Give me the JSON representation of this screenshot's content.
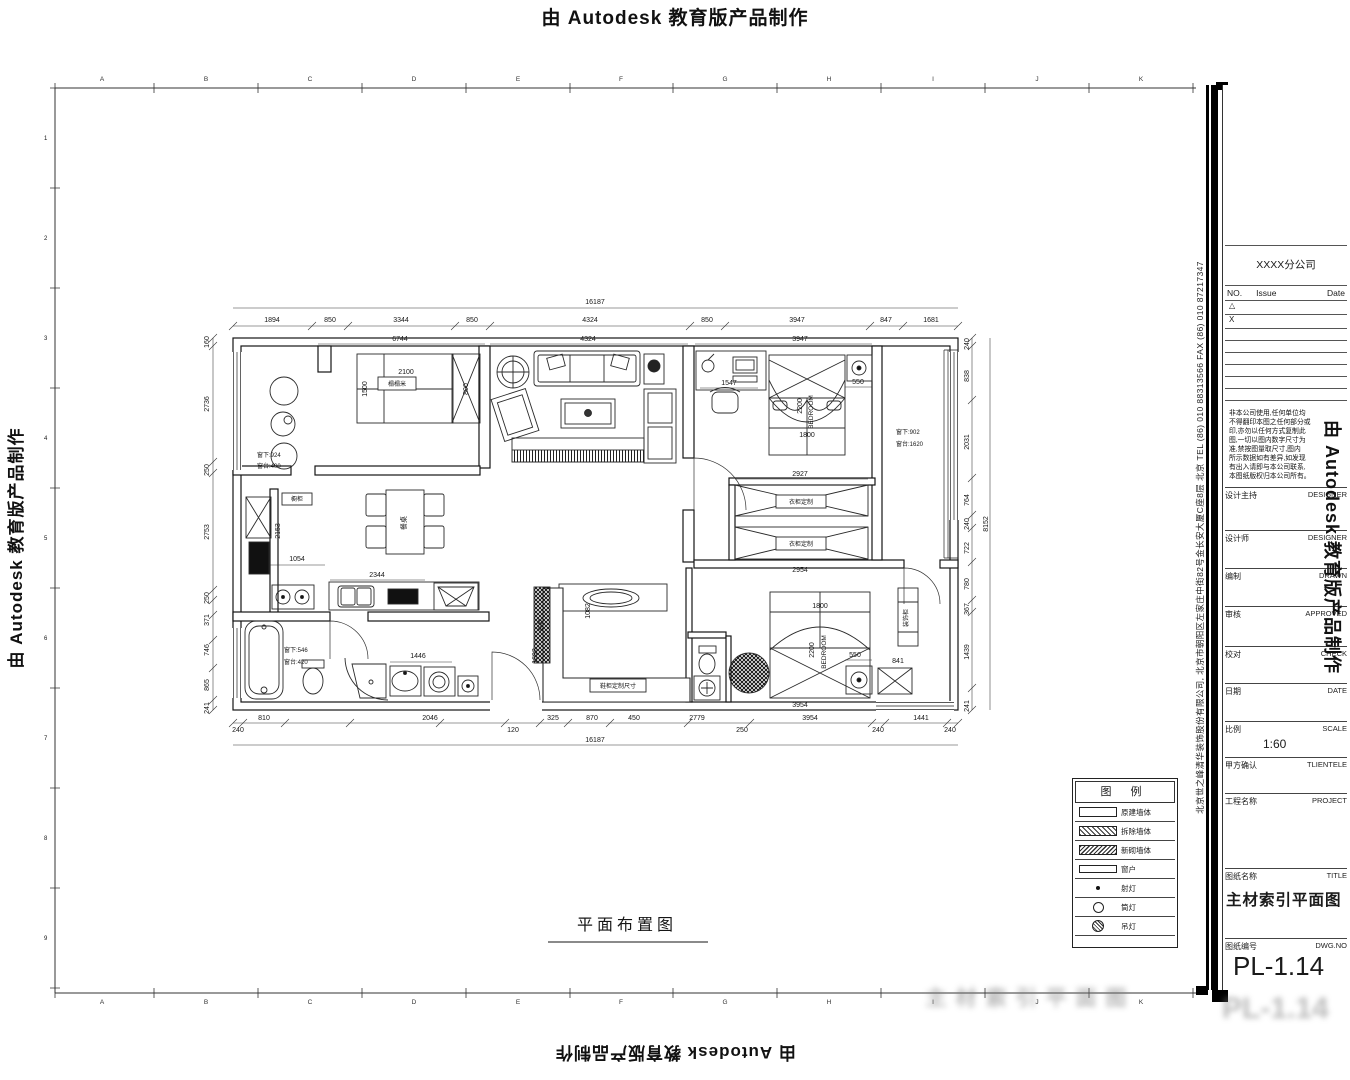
{
  "banner": {
    "text": "由 Autodesk 教育版产品制作"
  },
  "ruler": {
    "letters": [
      "A",
      "B",
      "C",
      "D",
      "E",
      "F",
      "G",
      "H",
      "I",
      "J",
      "K"
    ],
    "numbers": [
      "1",
      "2",
      "3",
      "4",
      "5",
      "6",
      "7",
      "8",
      "9"
    ]
  },
  "plan": {
    "title": "平面布置图",
    "overall_top": "16187",
    "overall_bottom": "16187",
    "overall_right": "8152",
    "d_top": [
      "1894",
      "850",
      "3344",
      "850",
      "4324",
      "850",
      "3947",
      "847",
      "1681"
    ],
    "d_top_inner": [
      "6744",
      "4324",
      "3947"
    ],
    "d_bottom": [
      "240",
      "810",
      "2046",
      "120",
      "325",
      "870",
      "450",
      "2779",
      "250",
      "3954",
      "240",
      "1441",
      "240"
    ],
    "d_left": [
      "160",
      "2736",
      "250",
      "2753",
      "250",
      "371",
      "746",
      "865",
      "241"
    ],
    "d_right": [
      "240",
      "838",
      "2031",
      "764",
      "240",
      "722",
      "780",
      "367",
      "1439",
      "241"
    ],
    "dims": {
      "tatami_w": "2100",
      "tatami_d": "1500",
      "closet_w": "800",
      "desk": "1547",
      "nightstand": "550",
      "ward1": "2927",
      "ward2": "2954",
      "bed1_w": "1800",
      "bed1_d": "2200",
      "bed2_w": "1800",
      "bed2_d": "2200",
      "bed2_wall": "3954",
      "kitchen_d": "2153",
      "kitchen_w": "1054",
      "counter": "2344",
      "bath": "1446",
      "foyer": "1692",
      "shoe": "1082",
      "night2": "550",
      "side": "841"
    },
    "labels": {
      "bedroom": "BEDROOM",
      "tatami": "榻榻米",
      "dining": "餐桌",
      "wardrobe": "衣柜定制",
      "shoe_cab": "鞋柜",
      "shoe_note": "鞋柜定制尺寸",
      "display": "装饰柜",
      "kitchen": "橱柜"
    },
    "notes": {
      "win_l1": "窗下:924",
      "win_l2": "窗台:400",
      "win_r1": "窗下:902",
      "win_r2": "窗台:1620",
      "win_b1": "窗下:546",
      "win_b2": "窗台:420"
    }
  },
  "legend": {
    "title": "图 例",
    "rows": [
      "原建墙体",
      "拆除墙体",
      "新砌墙体",
      "窗户",
      "射灯",
      "筒灯",
      "吊灯"
    ]
  },
  "titleblock": {
    "branch": "XXXX分公司",
    "rev": {
      "no": "NO.",
      "issue": "Issue",
      "date": "Date",
      "rows": [
        "△",
        "X"
      ]
    },
    "disclaimer": [
      "非本公司使用,任何单位均",
      "不得翻印本图之任何部分或",
      "印,亦勿以任何方式复制此",
      "图,一切以图内数字尺寸为",
      "准,禁按图量取尺寸,图内",
      "所示数据如有差异,如发现",
      "有出入请即与本公司联系,",
      "本图纸版权归本公司所有。"
    ],
    "fields": {
      "design_lead": {
        "cn": "设计主持",
        "en": "DESIGNER"
      },
      "designer": {
        "cn": "设计师",
        "en": "DESIGNER"
      },
      "drawn": {
        "cn": "编制",
        "en": "DRAWN"
      },
      "approved": {
        "cn": "审核",
        "en": "APPROVED"
      },
      "checked": {
        "cn": "校对",
        "en": "CHECK"
      },
      "date": {
        "cn": "日期",
        "en": "DATE"
      },
      "scale": {
        "cn": "比例",
        "en": "SCALE",
        "value": "1:60"
      },
      "client": {
        "cn": "甲方确认",
        "en": "TLIENTELE"
      },
      "project": {
        "cn": "工程名称",
        "en": "PROJECT"
      },
      "sheet_title": {
        "cn": "图纸名称",
        "en": "TITLE",
        "value": "主材索引平面图"
      },
      "dwg": {
        "cn": "图纸编号",
        "en": "DWG.NO",
        "value": "PL-1.14"
      }
    },
    "company_vertical": "北京世之峰清华装饰股份有限公司, 北京市朝阳区左家庄中街82号金长安大厦C座8层   北京   TEL (86) 010 88313566   FAX (86) 010 87217347"
  },
  "ghost": {
    "text": "主材索引平面图",
    "text2": "PL-1.14"
  }
}
